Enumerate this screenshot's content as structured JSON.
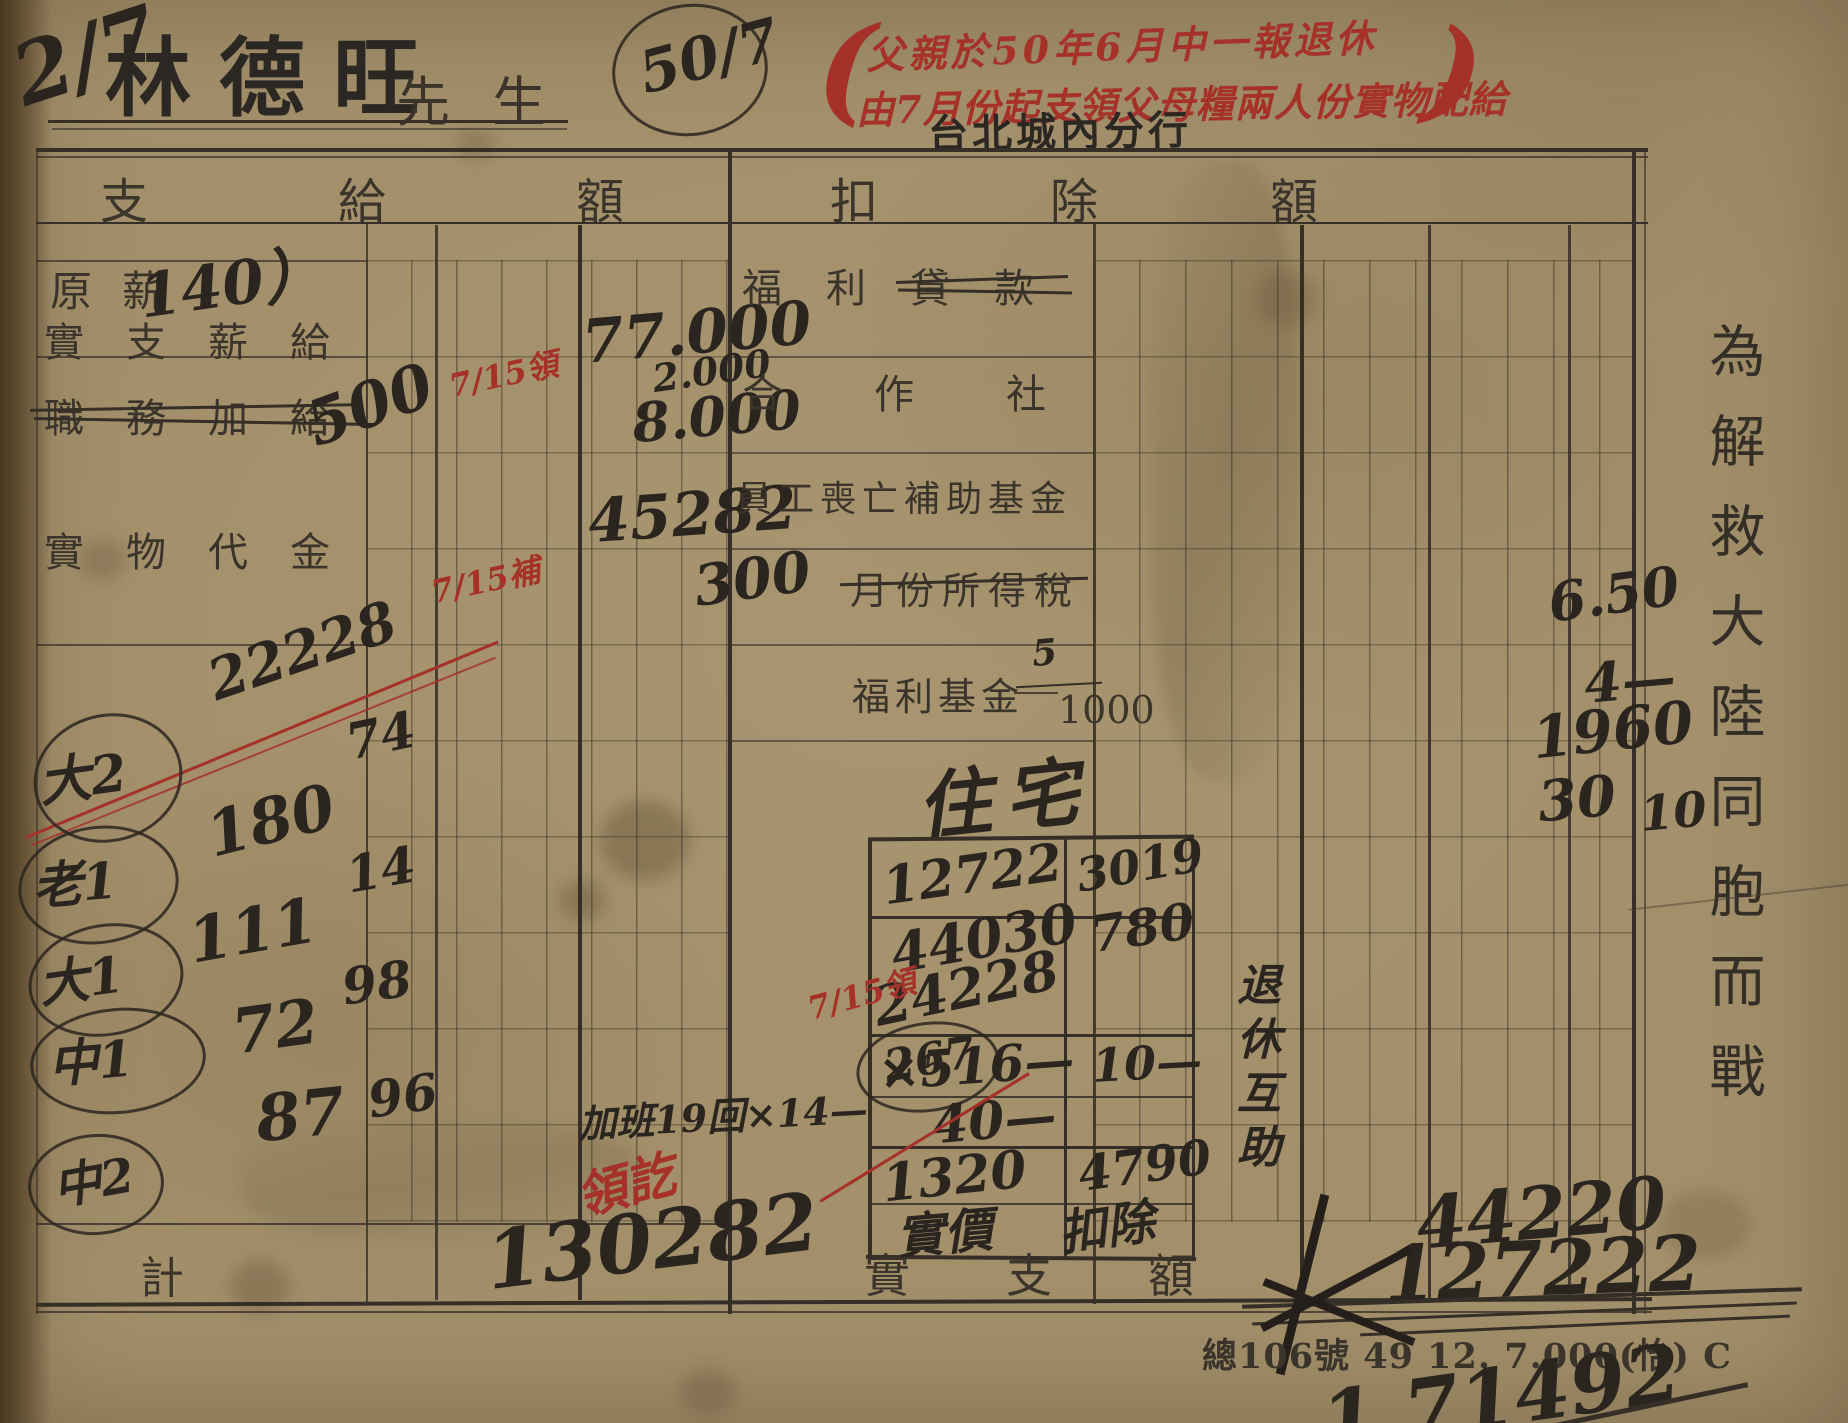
{
  "colors": {
    "paper": "#a3906b",
    "ink_black": "#2a251e",
    "ink_red": "#a5312a",
    "print_ink": "#3a342b"
  },
  "header": {
    "corner_mark": "2/7",
    "name": "林德旺",
    "honorific": "先生",
    "file_number": "50/7",
    "paren_open": "(",
    "paren_close": ")",
    "red_note_line1": "父親於50年6月中一報退休",
    "red_note_line2": "由7月份起支領父母糧兩人份實物配給",
    "branch": "台北城內分行"
  },
  "pay": {
    "header": "支給額",
    "row_labels": {
      "base": "原薪",
      "actual": "實支薪給",
      "duty": "職務加給",
      "goods": "實物代金"
    },
    "base_hw": "140）",
    "duty_hw": "500",
    "red_mark_top": "7/15領",
    "red_mark_mid": "7/15補",
    "amounts": {
      "a1": "77.000",
      "a2": "2.000",
      "a3": "8.000",
      "a4": "45282"
    },
    "family": [
      {
        "tag": "大2",
        "v1": "22228",
        "v2": ""
      },
      {
        "tag": "老1",
        "v1": "180",
        "v2": "74"
      },
      {
        "tag": "大1",
        "v1": "111",
        "v2": "14"
      },
      {
        "tag": "中1",
        "v1": "72",
        "v2": "98"
      },
      {
        "tag": "中2",
        "v1": "87",
        "v2": "96"
      }
    ],
    "overtime": "加班19回×14—",
    "received": "領訖",
    "total_label": "計",
    "total": "130282"
  },
  "deduction": {
    "header": "扣除額",
    "row_labels": {
      "welfare_loan": "福利貸款",
      "coop": "合作社",
      "death_fund": "員工喪亡補助基金",
      "income_tax": "月份所得稅",
      "welfare_fund": "福利基金"
    },
    "income_tax_hw": "300",
    "welfare_rate_num": "5",
    "welfare_rate_den": "1000",
    "housing": "住宅",
    "box": {
      "l1": "12722",
      "l2": "44030",
      "l3": "24228",
      "l4": "×516—",
      "l5": "40—",
      "l6": "1320",
      "r1": "3019",
      "r2": "780",
      "r3": "10—",
      "r4": "4790",
      "bl": "實價",
      "br": "扣除"
    },
    "red_mark": "7/15領",
    "circled": "267",
    "side_note": "退休互助",
    "amounts": {
      "d1": "6.50",
      "d2": "4—",
      "d3": "1960",
      "d4": "30",
      "d5": "10"
    },
    "net_label": "實支額",
    "net_interim": "44220",
    "net_crossed": "127222",
    "net_final": "1,71492"
  },
  "footer": {
    "print_code": "總106號 49 12. 7.000(怡) C"
  },
  "margin": {
    "slogan": "為解救大陸同胞而戰"
  }
}
